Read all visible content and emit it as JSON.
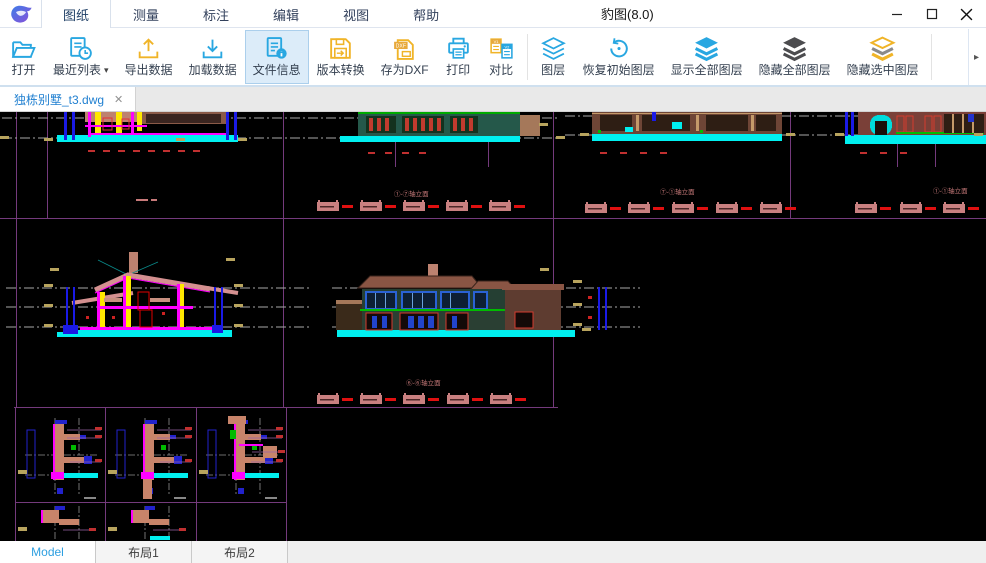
{
  "window": {
    "title": "豹图(8.0)"
  },
  "menu": {
    "tabs": [
      {
        "label": "图纸",
        "active": true
      },
      {
        "label": "测量"
      },
      {
        "label": "标注"
      },
      {
        "label": "编辑"
      },
      {
        "label": "视图"
      },
      {
        "label": "帮助"
      }
    ]
  },
  "toolbar": {
    "items": [
      {
        "label": "打开"
      },
      {
        "label": "最近列表",
        "dropdown": "▾"
      },
      {
        "label": "导出数据"
      },
      {
        "label": "加载数据"
      },
      {
        "label": "文件信息",
        "active": true
      },
      {
        "label": "版本转换"
      },
      {
        "label": "存为DXF",
        "badge": "DXF"
      },
      {
        "label": "打印"
      },
      {
        "label": "对比",
        "badge_left": "V1",
        "badge_right": "V2"
      },
      {
        "label": "图层"
      },
      {
        "label": "恢复初始图层"
      },
      {
        "label": "显示全部图层"
      },
      {
        "label": "隐藏全部图层"
      },
      {
        "label": "隐藏选中图层"
      }
    ],
    "expand_glyph": "▸"
  },
  "doc_tabs": {
    "tabs": [
      {
        "label": "独栋别墅_t3.dwg",
        "active": true
      }
    ],
    "close_glyph": "✕"
  },
  "canvas": {
    "sheet_titles": [
      "①-⑦轴立面",
      "⑦-①轴立面",
      "①-①轴立面",
      "⑥-⑥轴立面"
    ]
  },
  "layout_tabs": {
    "tabs": [
      {
        "label": "Model",
        "active": true
      },
      {
        "label": "布局1"
      },
      {
        "label": "布局2"
      }
    ]
  },
  "colors": {
    "accent_blue": "#29a7e1",
    "accent_yellow": "#f0b428",
    "active_item_bg": "#dcecf9",
    "canvas_bg": "#000000",
    "cad_cyan": "#00f0f0",
    "cad_magenta": "#ff00ff",
    "cad_yellow": "#ffe800",
    "cad_red": "#d42a2a",
    "cad_blue": "#1a1ae6",
    "cad_green": "#00bb00",
    "cad_purple": "#743a7c",
    "cad_pink": "#c98080",
    "cad_tan": "#bd8270"
  }
}
